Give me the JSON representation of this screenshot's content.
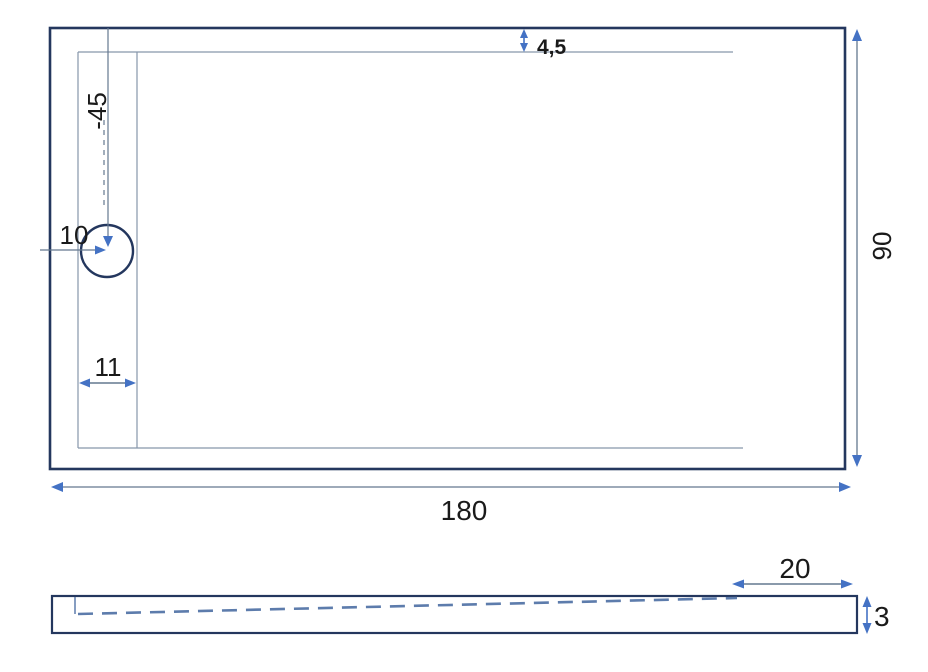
{
  "drawing_title": "shower-tray-dimension-drawing",
  "colors": {
    "outline": "#24375e",
    "accent": "#4472c4",
    "dim_line": "#64788f",
    "thin_line": "#8796ab",
    "dash_line": "#5d7cac",
    "text": "#1a1a1a",
    "background": "#ffffff"
  },
  "top_view": {
    "length_label": "180",
    "width_label": "90",
    "rim_inset_label": "4,5",
    "drain_offset_vertical_label": "-45",
    "drain_offset_horizontal_label": "10",
    "ledge_width_label": "11"
  },
  "side_view": {
    "flat_zone_label": "20",
    "thickness_label": "3"
  }
}
